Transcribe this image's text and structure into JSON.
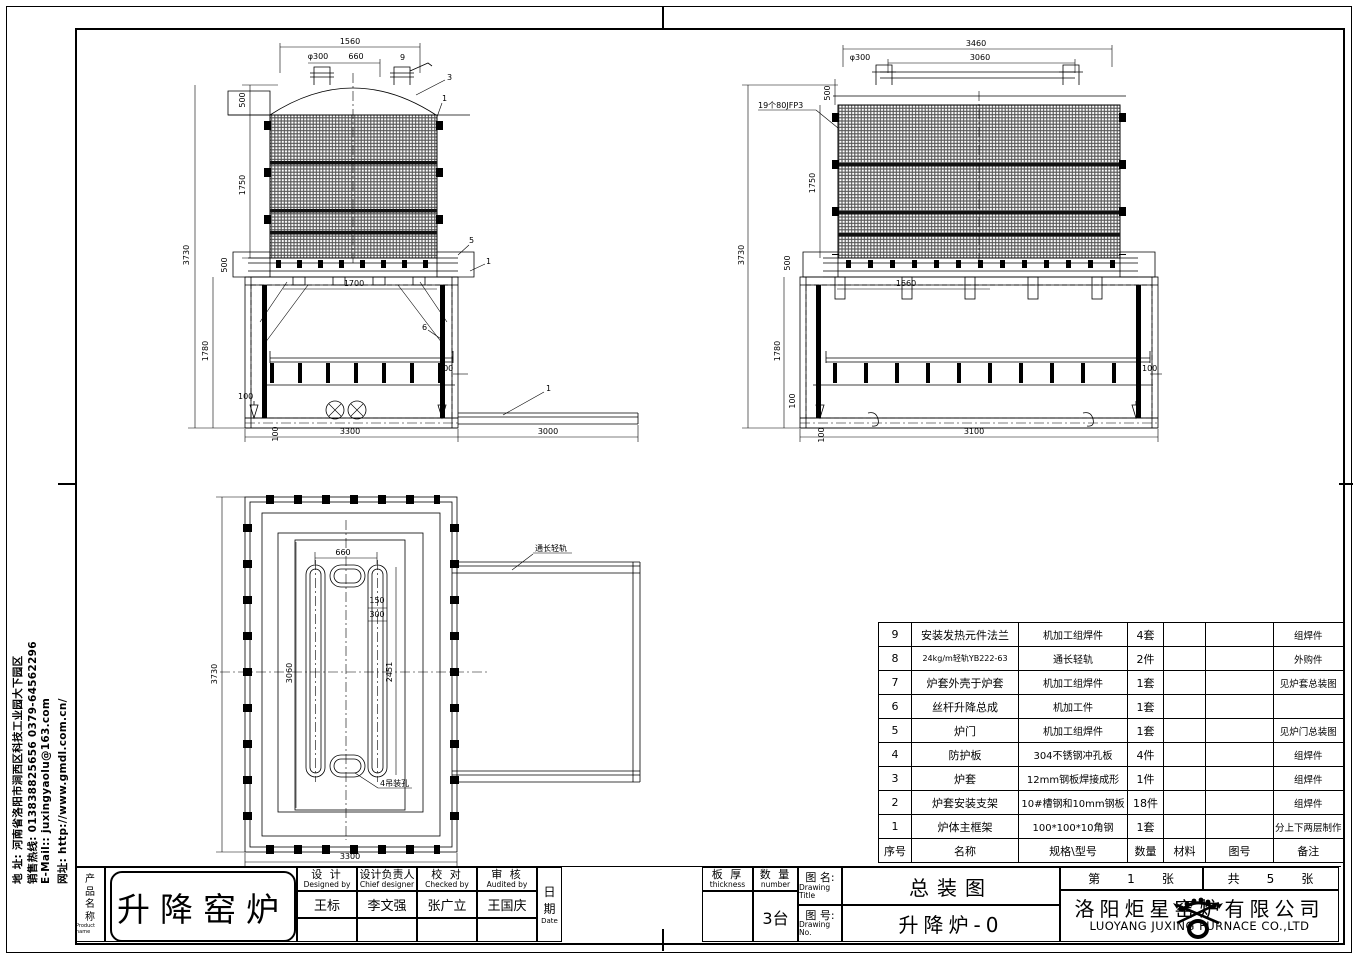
{
  "contact_sidebar": {
    "address": "地 址: 河南省洛阳市涧西区科技工业园大下园区",
    "hotline": "销售热线: 013838825656    0379-64562296",
    "email": "E-Mail::  juxingyaolu@163.com",
    "website": "网址: http://www.gmdl.com.cn/"
  },
  "views": {
    "front": {
      "dim_width_top": "1560",
      "dim_stub": "φ300",
      "dim_stub_span": "660",
      "dim_h_upper": "500",
      "dim_h_jacket": "1750",
      "dim_h_overall": "3730",
      "dim_strip": "500",
      "dim_door_width": "1700",
      "dim_h_frame": "1780",
      "dim_100_left": "100",
      "dim_100_right": "100",
      "dim_100_base": "100",
      "dim_width_frame": "3300",
      "dim_rail_length": "3000",
      "balloon_9": "9",
      "balloon_3": "3",
      "balloon_1a": "1",
      "balloon_5": "5",
      "balloon_1b": "1",
      "balloon_6": "6",
      "balloon_1c": "1"
    },
    "side": {
      "dim_width_top": "3460",
      "dim_width_inner": "3060",
      "dim_stub": "φ300",
      "dim_h_upper": "500",
      "dim_h_jacket": "1750",
      "dim_h_overall": "3730",
      "dim_strip": "500",
      "dim_door_width": "1660",
      "dim_h_frame": "1780",
      "dim_100_left": "100",
      "dim_100_right": "100",
      "dim_100_base": "100",
      "dim_width_frame": "3100",
      "jacket_note": "19个80JFP3"
    },
    "plan": {
      "dim_slot_span": "660",
      "dim_150": "150",
      "dim_300": "300",
      "dim_inner_left": "3060",
      "dim_inner_right": "2451",
      "dim_h_overall": "3730",
      "dim_width": "3300",
      "lug_note": "4吊装孔",
      "rail_note": "通长轻轨"
    }
  },
  "bom": {
    "headers": {
      "no": "序号",
      "name": "名称",
      "spec": "规格\\型号",
      "qty": "数量",
      "material": "材料",
      "drawing_no": "图号",
      "remark": "备注"
    },
    "rows": [
      {
        "no": "9",
        "name": "安装发热元件法兰",
        "spec": "机加工组焊件",
        "qty": "4套",
        "material": "",
        "drawing_no": "",
        "remark": "组焊件"
      },
      {
        "no": "8",
        "name": "24kg/m轻轨YB222-63",
        "spec": "通长轻轨",
        "qty": "2件",
        "material": "",
        "drawing_no": "",
        "remark": "外购件"
      },
      {
        "no": "7",
        "name": "炉套外壳于炉套",
        "spec": "机加工组焊件",
        "qty": "1套",
        "material": "",
        "drawing_no": "",
        "remark": "见炉套总装图"
      },
      {
        "no": "6",
        "name": "丝杆升降总成",
        "spec": "机加工件",
        "qty": "1套",
        "material": "",
        "drawing_no": "",
        "remark": ""
      },
      {
        "no": "5",
        "name": "炉门",
        "spec": "机加工组焊件",
        "qty": "1套",
        "material": "",
        "drawing_no": "",
        "remark": "见炉门总装图"
      },
      {
        "no": "4",
        "name": "防护板",
        "spec": "304不锈钢冲孔板",
        "qty": "4件",
        "material": "",
        "drawing_no": "",
        "remark": "组焊件"
      },
      {
        "no": "3",
        "name": "炉套",
        "spec": "12mm钢板焊接成形",
        "qty": "1件",
        "material": "",
        "drawing_no": "",
        "remark": "组焊件"
      },
      {
        "no": "2",
        "name": "炉套安装支架",
        "spec": "10#槽钢和10mm钢板",
        "qty": "18件",
        "material": "",
        "drawing_no": "",
        "remark": "组焊件"
      },
      {
        "no": "1",
        "name": "炉体主框架",
        "spec": "100*100*10角钢",
        "qty": "1套",
        "material": "",
        "drawing_no": "",
        "remark": "分上下两层制作"
      }
    ]
  },
  "titleblock": {
    "product_label_cn": "产品名称",
    "product_label_en": "Product name",
    "product_name": "升降窑炉",
    "roles": [
      {
        "cn": "设  计",
        "en": "Designed by",
        "name": "王标"
      },
      {
        "cn": "设计负责人",
        "en": "Chief designer",
        "name": "李文强"
      },
      {
        "cn": "校  对",
        "en": "Checked by",
        "name": "张广立"
      },
      {
        "cn": "审  核",
        "en": "Audited by",
        "name": "王国庆"
      }
    ],
    "date_cn": "日期",
    "date_en": "Date",
    "thickness_cn": "板  厚",
    "thickness_en": "thickness",
    "thickness_value": "",
    "quantity_cn": "数  量",
    "quantity_en": "number",
    "quantity_value": "3台",
    "title_label_cn": "图 名:",
    "title_label_en": "Drawing Title",
    "title_value": "总装图",
    "no_label_cn": "图 号:",
    "no_label_en": "Drawing No.",
    "no_value": "升降炉-0",
    "sheet": {
      "prefix": "第",
      "num": "1",
      "suffix": "张",
      "total_prefix": "共",
      "total_num": "5",
      "total_suffix": "张"
    },
    "company_cn": "洛阳炬星窑炉有限公司",
    "company_en": "LUOYANG JUXING FURNACE CO.,LTD"
  }
}
